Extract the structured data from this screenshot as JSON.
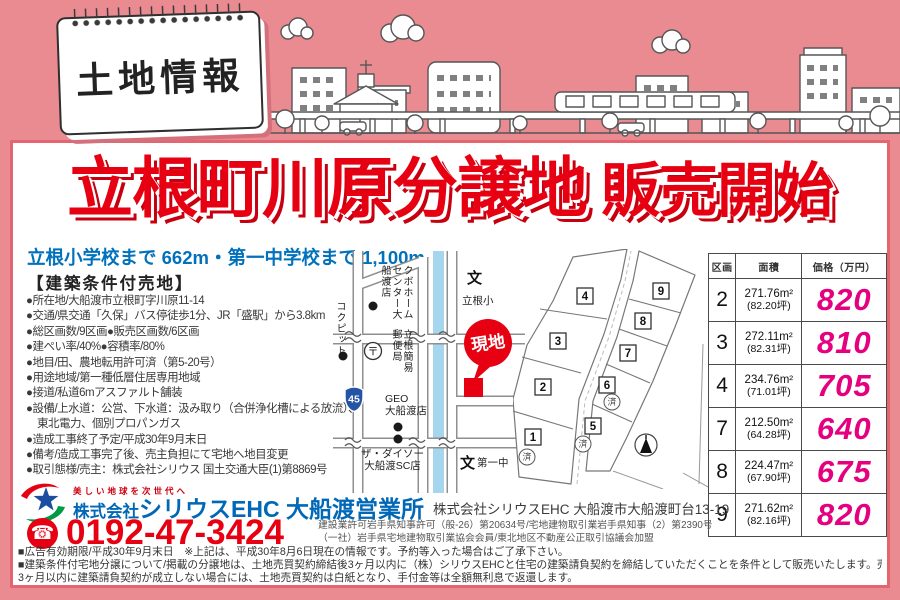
{
  "sign": {
    "title": "土地情報"
  },
  "title": {
    "main": "立根町川原分譲地",
    "sub": "販売開始"
  },
  "subtitle": "立根小学校まで 662m・第一中学校まで 1,100m",
  "conditions": {
    "heading": "【建築条件付売地】",
    "items": [
      "●所在地/大船渡市立根町字川原11-14",
      "●交通/県交通「久保」バス停徒歩1分、JR「盛駅」から3.8km",
      "●総区画数/9区画●販売区画数/6区画",
      "●建ぺい率/40%●容積率/80%",
      "●地目/田、農地転用許可済（第5-20号）",
      "●用途地域/第一種低層住居専用地域",
      "●接道/私道6mアスファルト舗装",
      "●設備/上水道：公営、下水道：汲み取り（合併浄化槽による放流）、",
      "　東北電力、個別プロパンガス",
      "●造成工事終了予定/平成30年9月末日",
      "●備考/造成工事完了後、売主負担にて宅地へ地目変更",
      "●取引態様/売主：株式会社シリウス 国土交通大臣(1)第8869号"
    ]
  },
  "map": {
    "kubo": "クボホームセンター大船渡店",
    "cockpit": "コクピット",
    "post_office": "立根簡易郵便局",
    "post_symbol": "〒",
    "school_mark": "文",
    "elementary": "立根小",
    "junior_high": "第一中",
    "geo_line1": "GEO",
    "geo_line2": "大船渡店",
    "daiso_line1": "ザ・ダイソー",
    "daiso_line2": "大船渡SC店",
    "site_badge": "現地",
    "route_number": "45"
  },
  "lots": {
    "sold_label": "済",
    "numbers": [
      "1",
      "2",
      "3",
      "4",
      "5",
      "6",
      "7",
      "8",
      "9"
    ]
  },
  "price_table": {
    "headers": {
      "lot": "区画",
      "area": "面積",
      "price": "価格（万円）"
    },
    "rows": [
      {
        "lot": "2",
        "area": "271.76m²",
        "tsubo": "(82.20坪)",
        "price": "820"
      },
      {
        "lot": "3",
        "area": "272.11m²",
        "tsubo": "(82.31坪)",
        "price": "810"
      },
      {
        "lot": "4",
        "area": "234.76m²",
        "tsubo": "(71.01坪)",
        "price": "705"
      },
      {
        "lot": "7",
        "area": "212.50m²",
        "tsubo": "(64.28坪)",
        "price": "640"
      },
      {
        "lot": "8",
        "area": "224.47m²",
        "tsubo": "(67.90坪)",
        "price": "675"
      },
      {
        "lot": "9",
        "area": "271.62m²",
        "tsubo": "(82.16坪)",
        "price": "820"
      }
    ]
  },
  "company": {
    "tagline": "美しい地球を次世代へ",
    "name_prefix": "株式会社",
    "name_main": "シリウスEHC 大船渡営業所",
    "phone_icon": "☎",
    "phone": "0192-47-3424",
    "address": "株式会社シリウスEHC 大船渡市大船渡町台13-19",
    "license1": "建設業許可岩手県知事許可（般-26）第20634号/宅地建物取引業岩手県知事（2）第2390号",
    "license2": "（一社）岩手県宅地建物取引業協会会員/東北地区不動産公正取引協議会加盟"
  },
  "footer": {
    "line1": "■広告有効期限/平成30年9月末日　※上記は、平成30年8月6日現在の情報です。予約等入った場合はご了承下さい。",
    "line2": "■建築条件付宅地分譲について/掲載の分譲地は、土地売買契約締結後3ヶ月以内に（株）シリウスEHCと住宅の建築請負契約を締結していただくことを条件として販売いたします。売買契約締結後、",
    "line3": "3ヶ月以内に建築請負契約が成立しない場合には、土地売買契約は白紙となり、手付金等は全額無利息で返還します。"
  }
}
